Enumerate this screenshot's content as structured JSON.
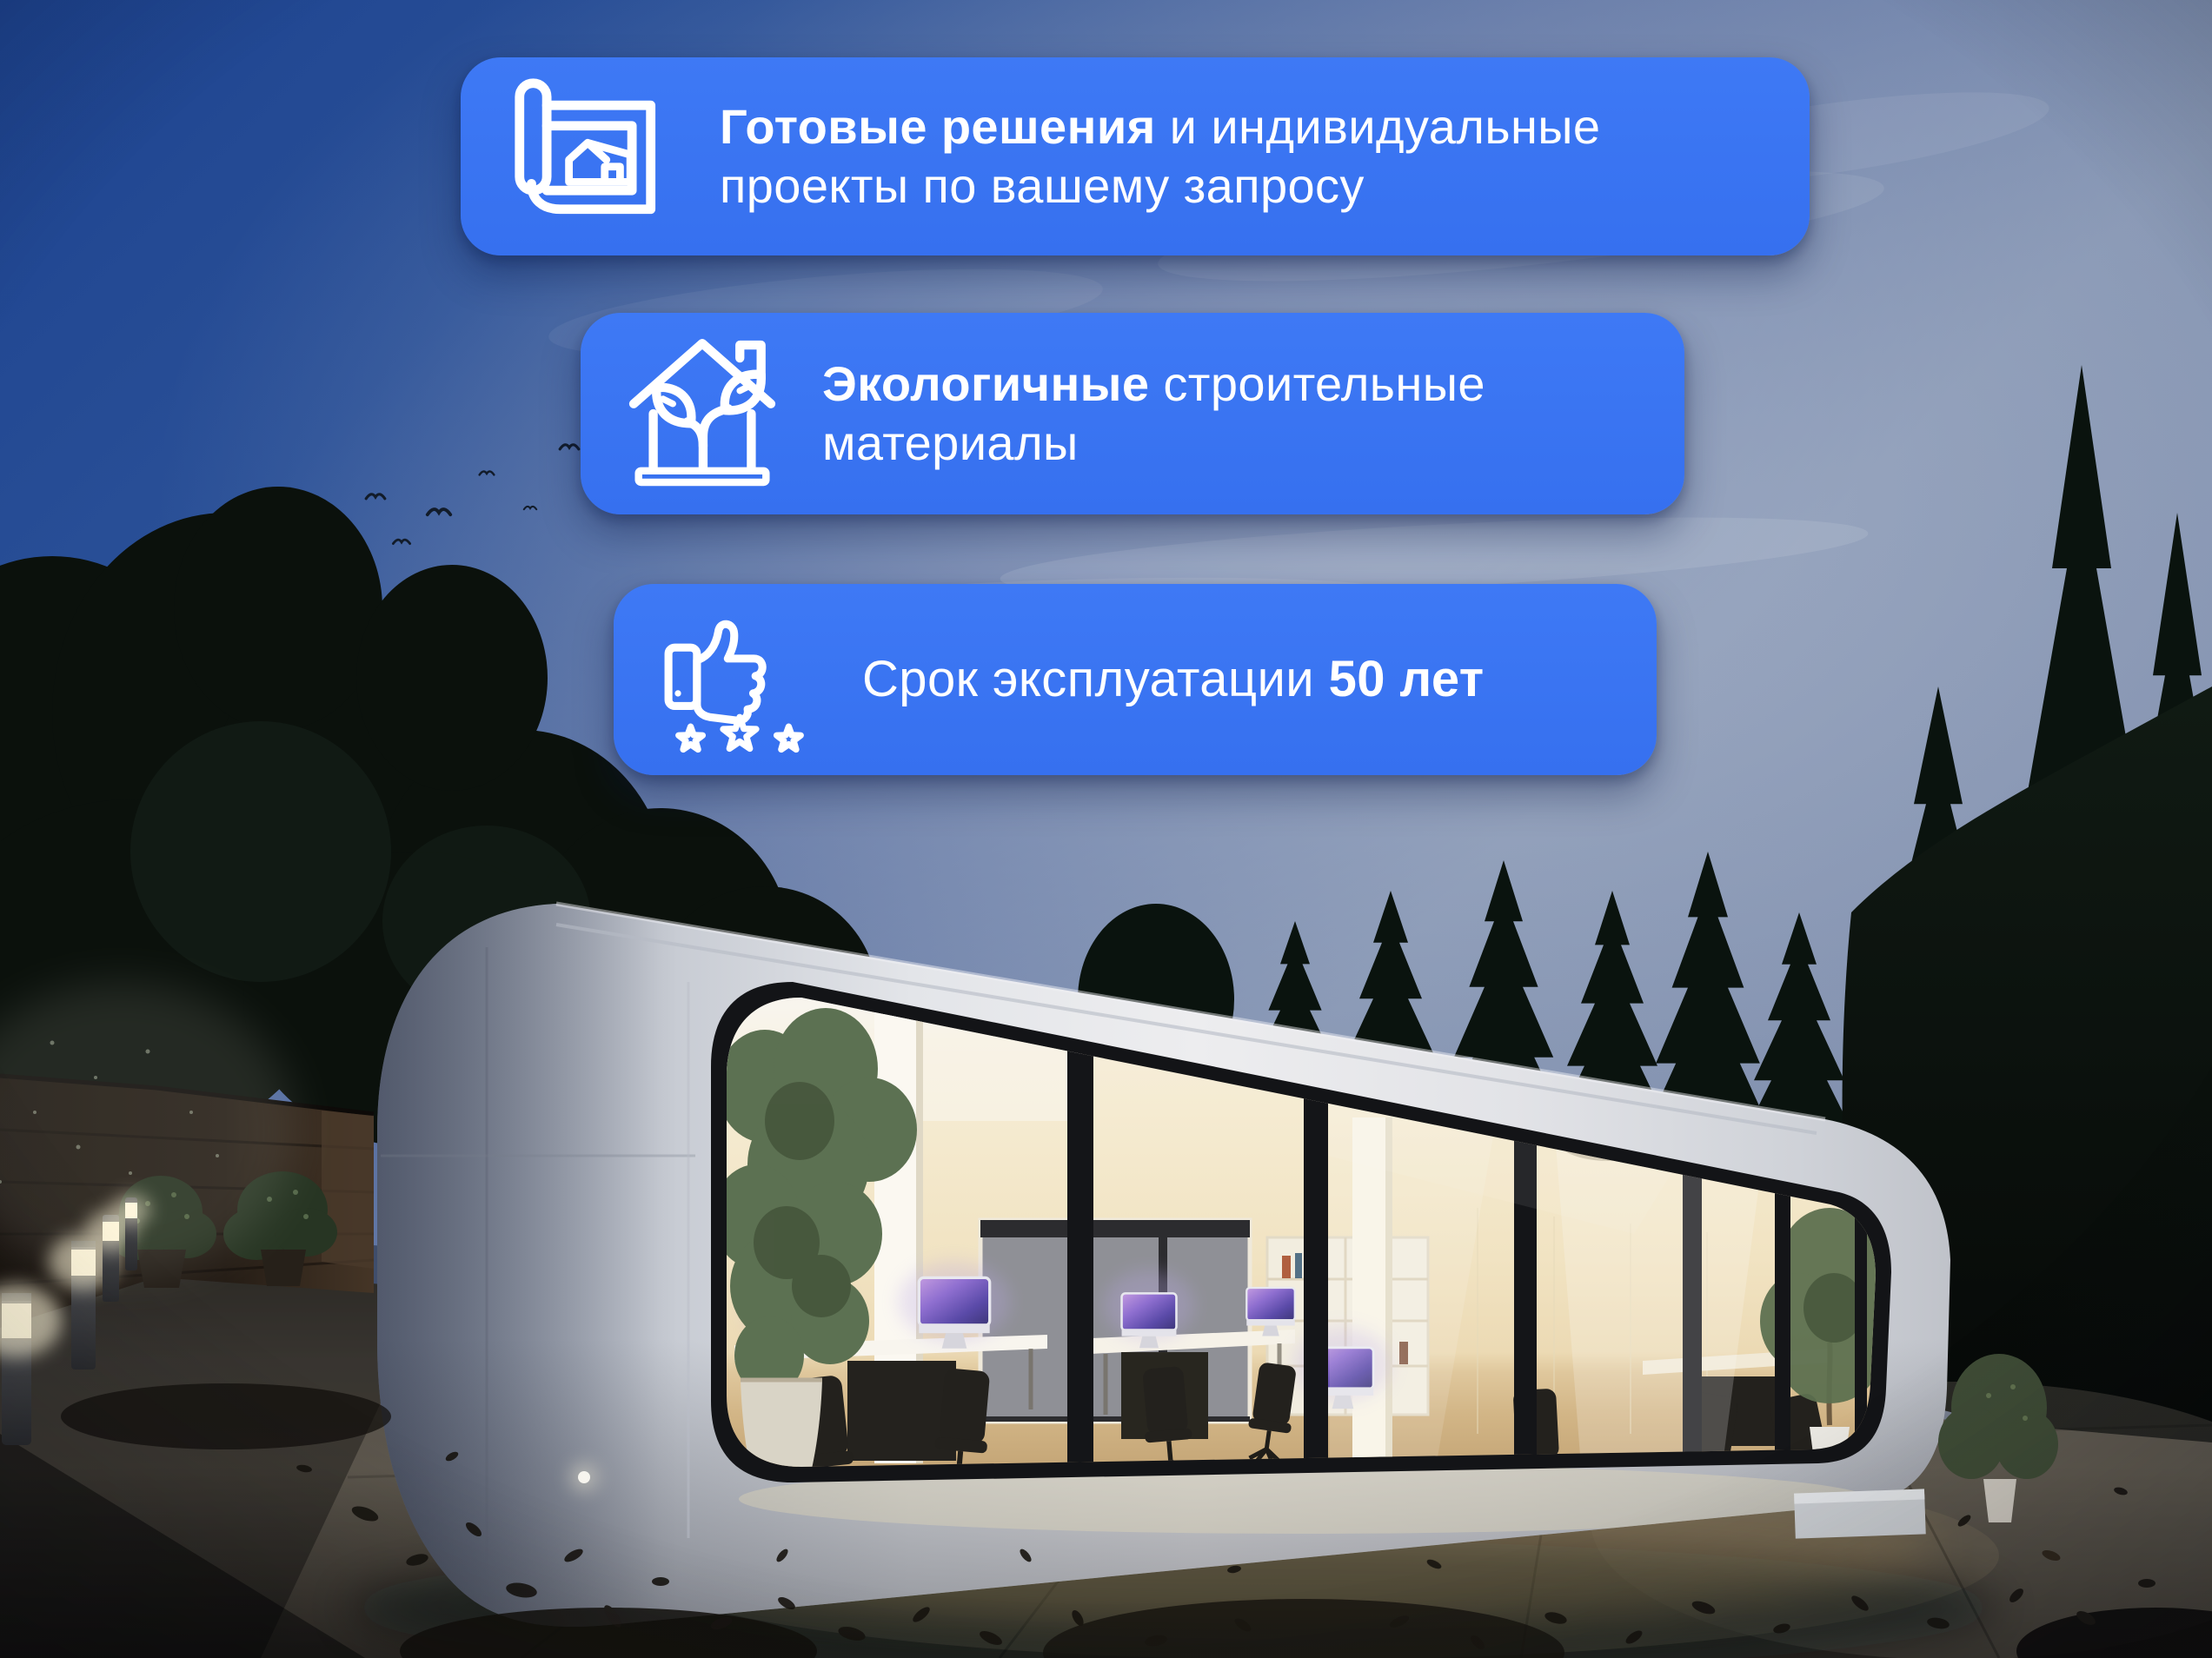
{
  "colors": {
    "banner_blue": "#3B74F2",
    "banner_text": "#FFFFFF",
    "sky_deep_blue": "#1E4591",
    "sky_light_gray_blue": "#8E9CB7",
    "building_shell": "#E6E8EC",
    "window_frame": "#141518",
    "interior_warm_glow": "#F2E5C6",
    "interior_floor_wood": "#C9AE81",
    "foliage_dark": "#0B130E",
    "ground_pavement": "#55504A"
  },
  "banners": [
    {
      "name": "ready-solutions",
      "icon": "blueprint-house-icon",
      "line1": [
        {
          "t": "Готовые решения",
          "bold": true
        },
        {
          "t": " и индивидуальные",
          "bold": false
        }
      ],
      "line2": [
        {
          "t": "проекты по вашему запросу",
          "bold": false
        }
      ]
    },
    {
      "name": "eco-materials",
      "icon": "eco-house-sprout-icon",
      "line1": [
        {
          "t": "Экологичные",
          "bold": true
        },
        {
          "t": " строительные",
          "bold": false
        }
      ],
      "line2": [
        {
          "t": "материалы",
          "bold": false
        }
      ]
    },
    {
      "name": "service-life",
      "icon": "thumbs-up-stars-icon",
      "line1": [
        {
          "t": "Срок эксплуатации ",
          "bold": false
        },
        {
          "t": "50 лет",
          "bold": true
        }
      ],
      "line2": []
    }
  ]
}
